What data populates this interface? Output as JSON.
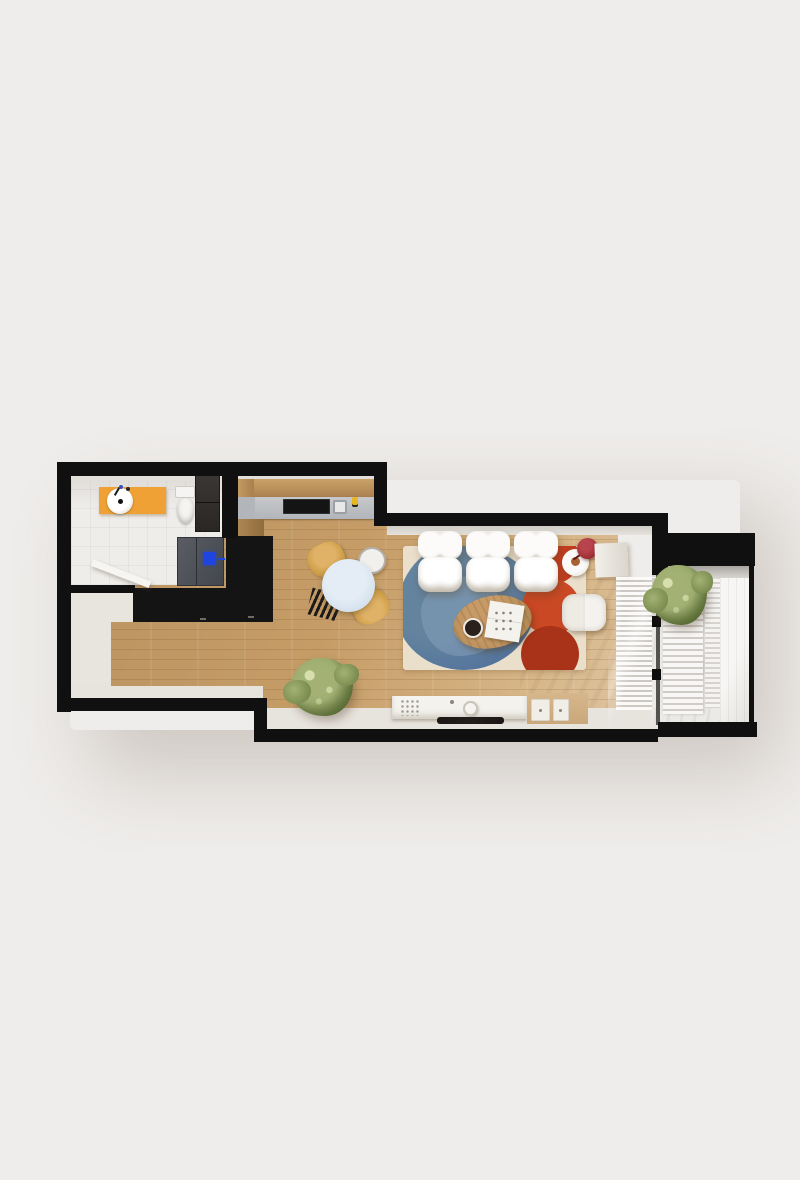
{
  "scene": {
    "title": "3D rendered apartment floor plan, top-down view",
    "view": "top-down",
    "rooms": [
      "bathroom",
      "hallway",
      "kitchen",
      "dining area",
      "living room",
      "balcony"
    ],
    "furniture_and_fixtures": [
      "orange vanity with round white sink and faucet",
      "toilet with tank",
      "dark bathroom cabinet",
      "open white bathroom door",
      "refrigerator with blue panel",
      "kitchen counter with black cooktop, sink and yellow bottle",
      "tall black kitchen cabinet block",
      "black lower kitchen cabinet run",
      "round pale-blue dining table",
      "two mustard dining chairs",
      "white dining chair",
      "black slatted dining chair",
      "white tufted three-seat sofa",
      "cream area rug with blue organic shape and red circles",
      "oval wooden coffee table with magazines and dark cup",
      "white square pouf",
      "round white side table",
      "dark red floor lamp",
      "white window bench",
      "white TV console with flat TV, speaker and decor",
      "wooden drawer chest with white drawers",
      "potted green plant in living room",
      "potted green plant on balcony",
      "interior white blinds",
      "sliding glass door with black handles",
      "white louvered balcony screens"
    ]
  },
  "colors": {
    "page-bg": "#efedeb",
    "wall": "#101010",
    "floor-wood": "#c59c66",
    "bath-floor": "#efedea",
    "hall-floor": "#e8e4de",
    "margin-floor": "#e7e3dd",
    "inner-face": "#e2dfda",
    "counter-gray": "#b2b5b9",
    "cabinet-black": "#141414",
    "fridge-gray": "#43474d",
    "appliance-blue": "#1e45df",
    "vanity-orange": "#f0a135",
    "faucet-blue": "#3b4ec4",
    "toilet-white": "#f5f4f2",
    "door-white": "#f6f5f2",
    "table-blue": "#d3e1ed",
    "chair-mustard": "#d2a24c",
    "chair-black": "#1d1b19",
    "chair-white": "#f2f0ec",
    "sofa-white": "#f5f3ef",
    "sofa-shadow": "#d8d3ca",
    "rug-cream": "#eadfcb",
    "rug-blue": "#4f6f9b",
    "rug-blue-light": "#8da7c1",
    "rug-red": "#c23c1f",
    "rug-red-deep": "#a83318",
    "coffee-wood": "#b28a55",
    "cup-dark": "#2a211d",
    "pouf-white": "#f4f2ee",
    "lamp-red": "#992b31",
    "amber": "#a96234",
    "console-white": "#f1efe9",
    "tv-black": "#241e1a",
    "drawer-wood": "#c9a87b",
    "drawer-front": "#f1eee7",
    "plant-green": "#75874b",
    "plant-light": "#a3b274",
    "balcony-floor": "#eceae6",
    "louver-white": "#f8f7f5",
    "louver-gap": "#cfccc8",
    "glass-dark": "#3a3836",
    "accent-yellow": "#e8b622"
  }
}
